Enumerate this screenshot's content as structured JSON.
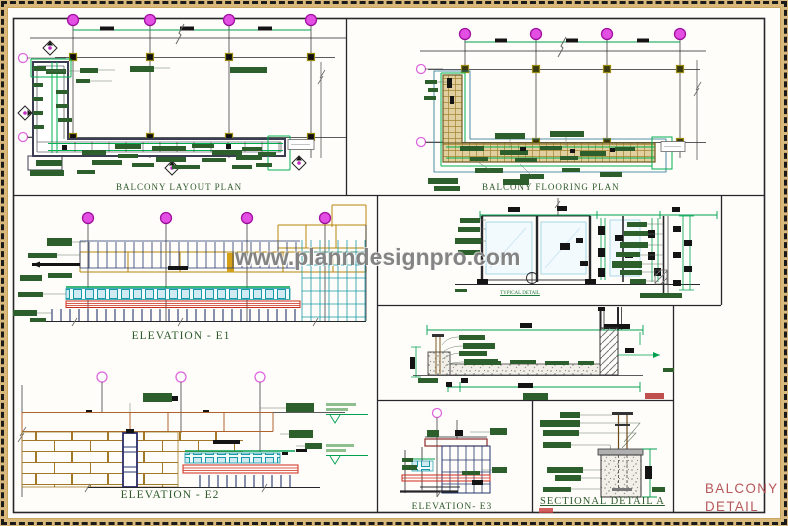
{
  "sheet": {
    "watermark": "www.planndesignpro.com",
    "title": {
      "line1": "BALCONY",
      "line2": "DETAIL"
    }
  },
  "panels": {
    "layout_plan": {
      "title": "BALCONY LAYOUT PLAN"
    },
    "flooring_plan": {
      "title": "BALCONY FLOORING PLAN"
    },
    "elevation_e1": {
      "title": "ELEVATION - E1"
    },
    "elevation_e2": {
      "title": "ELEVATION - E2"
    },
    "elevation_e3": {
      "title": "ELEVATION- E3"
    },
    "sectional_detail_a": {
      "title": "SECTIONAL DETAIL A"
    },
    "railing_detail": {
      "caption": "TYPICAL DETAIL"
    }
  },
  "colors": {
    "border_tan": "#d9b87c",
    "grid_bubble_magenta": "#e24fe2",
    "annotation_green": "#2d5f2d",
    "dimension_green": "#00a050",
    "glass_teal": "#1898a8",
    "structure_navy": "#23366e",
    "band_red": "#cc2a1a",
    "title_green": "#2d5a2d",
    "sheet_title_red": "#b5565a",
    "watermark_gray": "#767676"
  }
}
